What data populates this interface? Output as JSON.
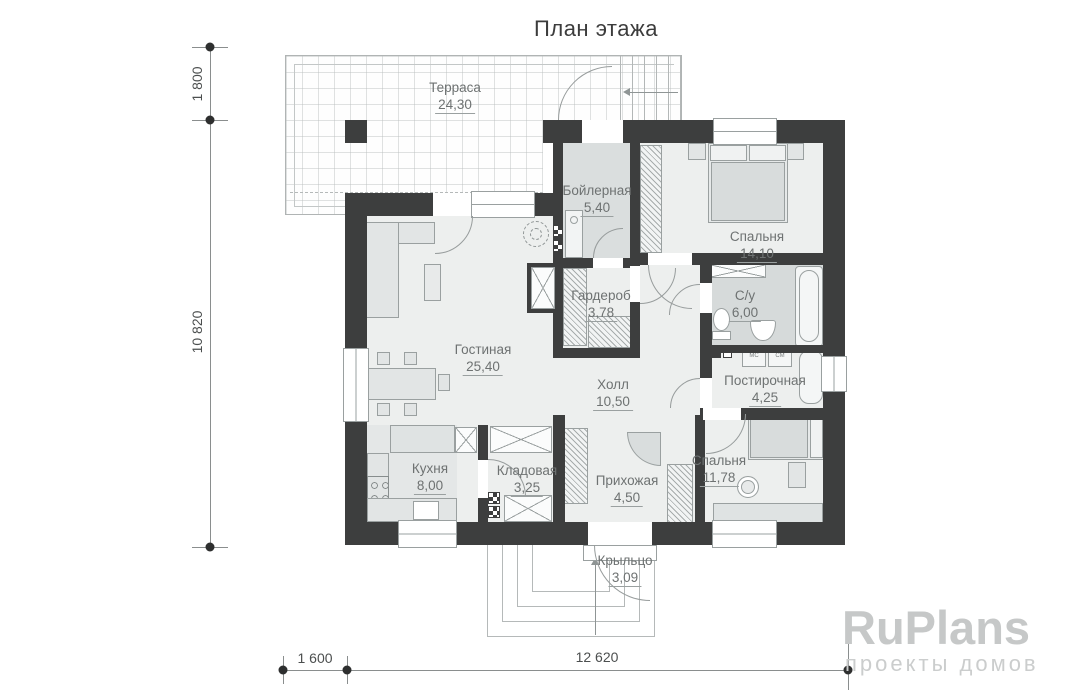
{
  "title": "План этажа",
  "rooms": [
    {
      "name": "Терраса",
      "area": "24,30"
    },
    {
      "name": "Бойлерная",
      "area": "5,40"
    },
    {
      "name": "Спальня",
      "area": "14,10"
    },
    {
      "name": "Гардероб",
      "area": "3,78"
    },
    {
      "name": "С/у",
      "area": "6,00"
    },
    {
      "name": "Гостиная",
      "area": "25,40"
    },
    {
      "name": "Холл",
      "area": "10,50"
    },
    {
      "name": "Постирочная",
      "area": "4,25"
    },
    {
      "name": "Кухня",
      "area": "8,00"
    },
    {
      "name": "Кладовая",
      "area": "3,25"
    },
    {
      "name": "Прихожая",
      "area": "4,50"
    },
    {
      "name": "Спальня",
      "area": "11,78"
    },
    {
      "name": "Крыльцо",
      "area": "3,09"
    }
  ],
  "dimensions": {
    "left_top": "1 800",
    "left_main": "10 820",
    "bottom_left": "1 600",
    "bottom_main": "12 620"
  },
  "appliances": {
    "mc": "МС",
    "cm": "СМ"
  },
  "logo": {
    "brand": "RuPlans",
    "tagline": "проекты домов"
  },
  "colors": {
    "wall": "#3d3e3e",
    "floor": "#edefee",
    "wet_floor": "#d6dada",
    "line": "#9aa0a0",
    "label_text": "#6e7272",
    "dimension_text": "#4c4f4f",
    "logo_gray": "#c6c8c8"
  }
}
